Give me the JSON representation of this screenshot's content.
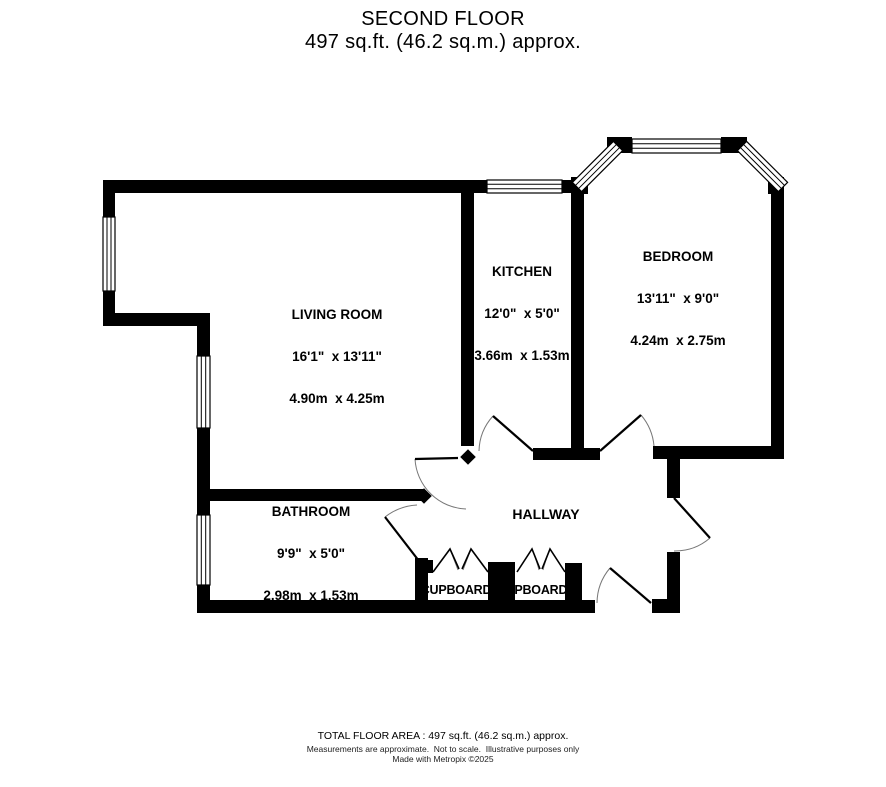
{
  "header": {
    "floor_name": "SECOND FLOOR",
    "floor_area": "497 sq.ft. (46.2 sq.m.) approx."
  },
  "rooms": {
    "living_room": {
      "name": "LIVING ROOM",
      "dims_imperial": "16'1\"  x 13'11\"",
      "dims_metric": "4.90m  x 4.25m"
    },
    "kitchen": {
      "name": "KITCHEN",
      "dims_imperial": "12'0\"  x 5'0\"",
      "dims_metric": "3.66m  x 1.53m"
    },
    "bedroom": {
      "name": "BEDROOM",
      "dims_imperial": "13'11\"  x 9'0\"",
      "dims_metric": "4.24m  x 2.75m"
    },
    "bathroom": {
      "name": "BATHROOM",
      "dims_imperial": "9'9\"  x 5'0\"",
      "dims_metric": "2.98m  x 1.53m"
    },
    "hallway": {
      "name": "HALLWAY"
    },
    "cupboard_1": {
      "name": "CUPBOARD"
    },
    "cupboard_2": {
      "name": "CUPBOARD"
    }
  },
  "footer": {
    "total_area": "TOTAL FLOOR AREA : 497 sq.ft. (46.2 sq.m.) approx.",
    "disclaimer": "Measurements are approximate.  Not to scale.  Illustrative purposes only",
    "credit": "Made with Metropix ©2025"
  },
  "colors": {
    "wall": "#000000",
    "background": "#ffffff",
    "door_arc": "#777777"
  }
}
